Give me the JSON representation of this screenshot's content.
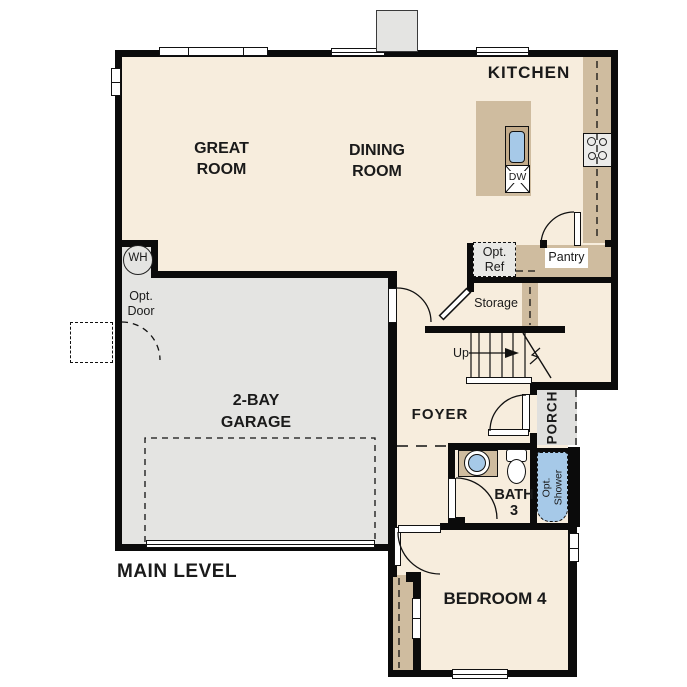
{
  "colors": {
    "wall": "#0b0b0b",
    "floor": "#f7eddd",
    "garage": "#e4e4e2",
    "porch": "#e0e0de",
    "counter": "#cfbc9f",
    "sinkframe": "#c3ab8a",
    "fixture_blue": "#a6c9e8",
    "ref_fill": "#e8e8e5",
    "cooktop_fill": "#ececea"
  },
  "labels": {
    "main_level": "MAIN LEVEL",
    "kitchen": "KITCHEN",
    "great_room": [
      "GREAT",
      "ROOM"
    ],
    "dining_room": [
      "DINING",
      "ROOM"
    ],
    "garage": [
      "2-BAY",
      "GARAGE"
    ],
    "foyer": "FOYER",
    "porch": "PORCH",
    "bath": [
      "BATH",
      "3"
    ],
    "bedroom": "BEDROOM 4",
    "pantry": "Pantry",
    "storage": "Storage",
    "stairs_up": "Up",
    "water_heater": "WH",
    "dishwasher": "DW",
    "opt_door": [
      "Opt.",
      "Door"
    ],
    "opt_ref": [
      "Opt.",
      "Ref"
    ],
    "opt_shower": [
      "Opt.",
      "Shower"
    ]
  }
}
